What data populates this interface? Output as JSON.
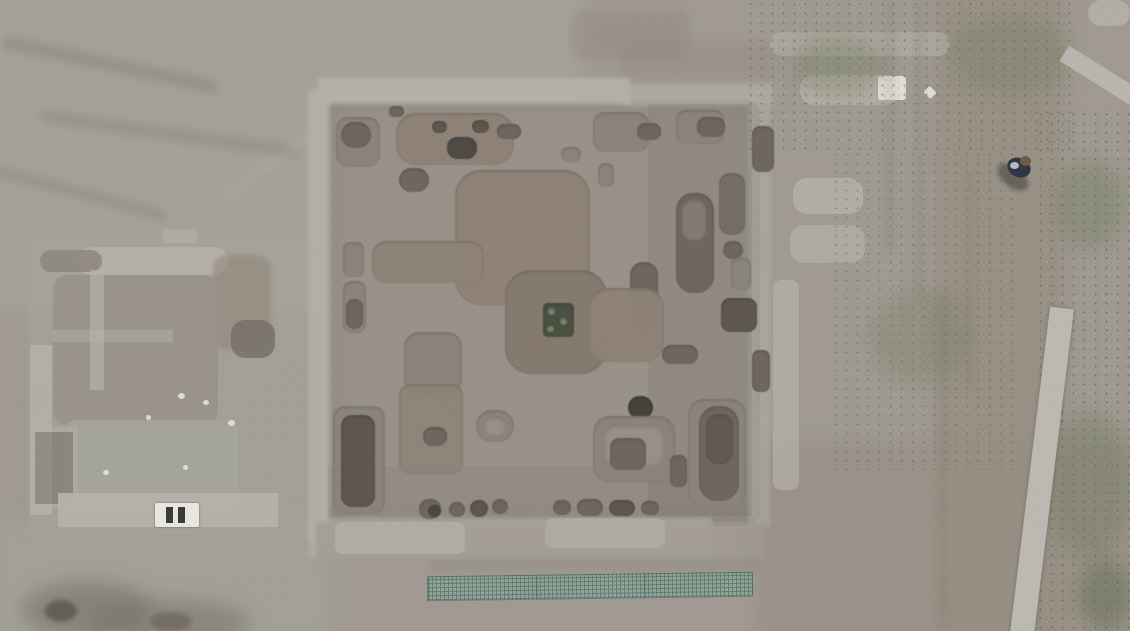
{
  "scene": {
    "type": "aerial-drone-photograph",
    "subject": "Top-down drone view of an archaeological excavation site: a large square trench full of pits and grave-like cuts, stone ruins to the west, dirt paths, scrub vegetation and a lone person walking on the upper-right path",
    "features": {
      "excavation_square": "Large square excavation bounded by light stone baulks, containing rectangular trenches, circular pits and brown earthen mounds",
      "central_feature": "Raised earthen platform near the center with a small dark square pit cut into it",
      "ruins_compound": "Low stone wall foundations of a ruined building west of the main trench",
      "ladder_object": "Small white slatted object lying on the south wall of the ruins",
      "rubble_bands": "Scatters of white stone rubble along the trench edges and top-right wall line",
      "person": "Single person in dark clothing walking on the dirt path, upper right",
      "dirt_path": "Pale dirt track running down the right side of the frame",
      "gravel_band": "Narrow light gravel band running from upper right toward the bottom edge, plus a short diagonal band in the top-right corner",
      "mesh_panels": "Long teal wire-mesh panel strip lying flat south of the excavation square",
      "vegetation": "Patchy green scrub on the right portion and top-right of the frame",
      "dark_mound": "Dark rocky spoil patch in the lower-left corner"
    }
  },
  "palette": {
    "ground": "#a09a92",
    "groundTL": "#a7a69c",
    "dirtWarm": "#988f84",
    "floor": "#99928a",
    "stone": "#b6b2aa",
    "stoneBright": "#d6d3cc",
    "white": "#e9e7e1",
    "mound": "#8f8377",
    "moundDark": "#867a6e",
    "pitMid": "#8b847c",
    "pitDark": "#6e675f",
    "pitDarker": "#5d574f",
    "pitDarkest": "#45413b",
    "greenPit": "#4a5143",
    "greenPitDot": "#7a8a6d",
    "veg": "#6b7759",
    "vegDark": "#566349",
    "gravel": "#bcb9b3",
    "mesh": "#93a69d",
    "meshLine": "#5d7a6e",
    "personBody": "#2f3542",
    "personHead": "#6f5b43",
    "rubbleDark": "#746e66"
  },
  "pits": [
    {
      "x": 336,
      "y": 117,
      "w": 44,
      "h": 50,
      "r": 12,
      "c": "pitMid"
    },
    {
      "x": 341,
      "y": 122,
      "w": 30,
      "h": 26,
      "r": 13,
      "c": "pitDark"
    },
    {
      "x": 396,
      "y": 113,
      "w": 118,
      "h": 52,
      "r": 20,
      "c": "mound"
    },
    {
      "x": 432,
      "y": 121,
      "w": 15,
      "h": 12,
      "r": 7,
      "c": "pitDarker"
    },
    {
      "x": 472,
      "y": 120,
      "w": 17,
      "h": 13,
      "r": 7,
      "c": "pitDarker"
    },
    {
      "x": 497,
      "y": 124,
      "w": 24,
      "h": 15,
      "r": 7,
      "c": "pitDark"
    },
    {
      "x": 447,
      "y": 137,
      "w": 30,
      "h": 22,
      "r": 10,
      "c": "pitDarkest",
      "o": 0.85
    },
    {
      "x": 399,
      "y": 168,
      "w": 30,
      "h": 24,
      "r": 12,
      "c": "pitDark"
    },
    {
      "x": 389,
      "y": 106,
      "w": 15,
      "h": 11,
      "r": 5,
      "c": "pitDark"
    },
    {
      "x": 561,
      "y": 147,
      "w": 20,
      "h": 15,
      "r": 7,
      "c": "pitMid"
    },
    {
      "x": 598,
      "y": 163,
      "w": 16,
      "h": 24,
      "r": 7,
      "c": "pitMid"
    },
    {
      "x": 593,
      "y": 112,
      "w": 56,
      "h": 40,
      "r": 12,
      "c": "pitMid"
    },
    {
      "x": 637,
      "y": 123,
      "w": 24,
      "h": 17,
      "r": 8,
      "c": "pitDark"
    },
    {
      "x": 676,
      "y": 110,
      "w": 48,
      "h": 34,
      "r": 10,
      "c": "pitMid"
    },
    {
      "x": 697,
      "y": 117,
      "w": 28,
      "h": 20,
      "r": 9,
      "c": "pitDark"
    },
    {
      "x": 752,
      "y": 126,
      "w": 22,
      "h": 46,
      "r": 8,
      "c": "pitDark"
    },
    {
      "x": 676,
      "y": 193,
      "w": 38,
      "h": 100,
      "r": 17,
      "c": "pitDark"
    },
    {
      "x": 682,
      "y": 200,
      "w": 24,
      "h": 40,
      "r": 10,
      "c": "pitMid",
      "o": 0.7
    },
    {
      "x": 719,
      "y": 173,
      "w": 26,
      "h": 62,
      "r": 11,
      "c": "pitDark",
      "o": 0.8
    },
    {
      "x": 630,
      "y": 262,
      "w": 28,
      "h": 70,
      "r": 13,
      "c": "pitDark"
    },
    {
      "x": 723,
      "y": 241,
      "w": 20,
      "h": 18,
      "r": 9,
      "c": "pitDark"
    },
    {
      "x": 731,
      "y": 258,
      "w": 20,
      "h": 32,
      "r": 7,
      "c": "pitMid"
    },
    {
      "x": 721,
      "y": 298,
      "w": 36,
      "h": 34,
      "r": 9,
      "c": "pitDarker"
    },
    {
      "x": 662,
      "y": 345,
      "w": 36,
      "h": 19,
      "r": 9,
      "c": "pitDark"
    },
    {
      "x": 752,
      "y": 350,
      "w": 18,
      "h": 42,
      "r": 7,
      "c": "pitDark"
    },
    {
      "x": 455,
      "y": 170,
      "w": 135,
      "h": 135,
      "r": 26,
      "c": "mound"
    },
    {
      "x": 372,
      "y": 241,
      "w": 112,
      "h": 42,
      "r": 14,
      "c": "mound",
      "o": 0.9
    },
    {
      "x": 505,
      "y": 270,
      "w": 102,
      "h": 104,
      "r": 26,
      "c": "moundDark"
    },
    {
      "x": 588,
      "y": 288,
      "w": 76,
      "h": 74,
      "r": 20,
      "c": "mound",
      "o": 0.95
    },
    {
      "x": 543,
      "y": 303,
      "w": 31,
      "h": 34,
      "r": 5,
      "c": "greenPit"
    },
    {
      "x": 548,
      "y": 308,
      "w": 7,
      "h": 7,
      "r": 4,
      "c": "greenPitDot"
    },
    {
      "x": 560,
      "y": 318,
      "w": 7,
      "h": 7,
      "r": 4,
      "c": "greenPitDot"
    },
    {
      "x": 547,
      "y": 326,
      "w": 7,
      "h": 6,
      "r": 3,
      "c": "greenPitDot"
    },
    {
      "x": 343,
      "y": 242,
      "w": 21,
      "h": 35,
      "r": 7,
      "c": "pitMid"
    },
    {
      "x": 343,
      "y": 281,
      "w": 23,
      "h": 52,
      "r": 9,
      "c": "pitMid"
    },
    {
      "x": 346,
      "y": 299,
      "w": 17,
      "h": 30,
      "r": 9,
      "c": "pitDark"
    },
    {
      "x": 404,
      "y": 332,
      "w": 58,
      "h": 62,
      "r": 15,
      "c": "pitMid"
    },
    {
      "x": 399,
      "y": 384,
      "w": 64,
      "h": 90,
      "r": 11,
      "c": "mound",
      "o": 0.85
    },
    {
      "x": 423,
      "y": 427,
      "w": 24,
      "h": 19,
      "r": 9,
      "c": "pitDark"
    },
    {
      "x": 333,
      "y": 406,
      "w": 52,
      "h": 108,
      "r": 12,
      "c": "pitMid"
    },
    {
      "x": 341,
      "y": 415,
      "w": 34,
      "h": 92,
      "r": 11,
      "c": "pitDarker"
    },
    {
      "x": 476,
      "y": 410,
      "w": 38,
      "h": 32,
      "r": 16,
      "c": "pitMid"
    },
    {
      "x": 484,
      "y": 417,
      "w": 22,
      "h": 18,
      "r": 9,
      "c": "floor",
      "o": 0.9
    },
    {
      "x": 419,
      "y": 499,
      "w": 22,
      "h": 20,
      "r": 10,
      "c": "pitDark"
    },
    {
      "x": 428,
      "y": 505,
      "w": 13,
      "h": 12,
      "r": 6,
      "c": "pitDarkest",
      "o": 0.8
    },
    {
      "x": 449,
      "y": 502,
      "w": 16,
      "h": 15,
      "r": 8,
      "c": "pitDark"
    },
    {
      "x": 470,
      "y": 500,
      "w": 18,
      "h": 17,
      "r": 9,
      "c": "pitDarker"
    },
    {
      "x": 492,
      "y": 499,
      "w": 16,
      "h": 15,
      "r": 8,
      "c": "pitDark"
    },
    {
      "x": 553,
      "y": 500,
      "w": 18,
      "h": 15,
      "r": 8,
      "c": "pitDark"
    },
    {
      "x": 577,
      "y": 499,
      "w": 26,
      "h": 17,
      "r": 9,
      "c": "pitDark"
    },
    {
      "x": 609,
      "y": 500,
      "w": 26,
      "h": 16,
      "r": 8,
      "c": "pitDarker"
    },
    {
      "x": 641,
      "y": 501,
      "w": 18,
      "h": 14,
      "r": 7,
      "c": "pitDark"
    },
    {
      "x": 628,
      "y": 396,
      "w": 25,
      "h": 23,
      "r": 12,
      "c": "pitDarkest"
    },
    {
      "x": 593,
      "y": 416,
      "w": 82,
      "h": 66,
      "r": 17,
      "c": "pitMid"
    },
    {
      "x": 604,
      "y": 425,
      "w": 60,
      "h": 40,
      "r": 12,
      "c": "floor",
      "o": 0.9
    },
    {
      "x": 610,
      "y": 438,
      "w": 36,
      "h": 32,
      "r": 9,
      "c": "pitDark"
    },
    {
      "x": 670,
      "y": 455,
      "w": 17,
      "h": 32,
      "r": 7,
      "c": "pitDark"
    },
    {
      "x": 688,
      "y": 399,
      "w": 58,
      "h": 108,
      "r": 16,
      "c": "pitMid"
    },
    {
      "x": 699,
      "y": 406,
      "w": 40,
      "h": 95,
      "r": 18,
      "c": "pitDark"
    },
    {
      "x": 706,
      "y": 414,
      "w": 27,
      "h": 50,
      "r": 12,
      "c": "pitDarker",
      "o": 0.8
    }
  ]
}
